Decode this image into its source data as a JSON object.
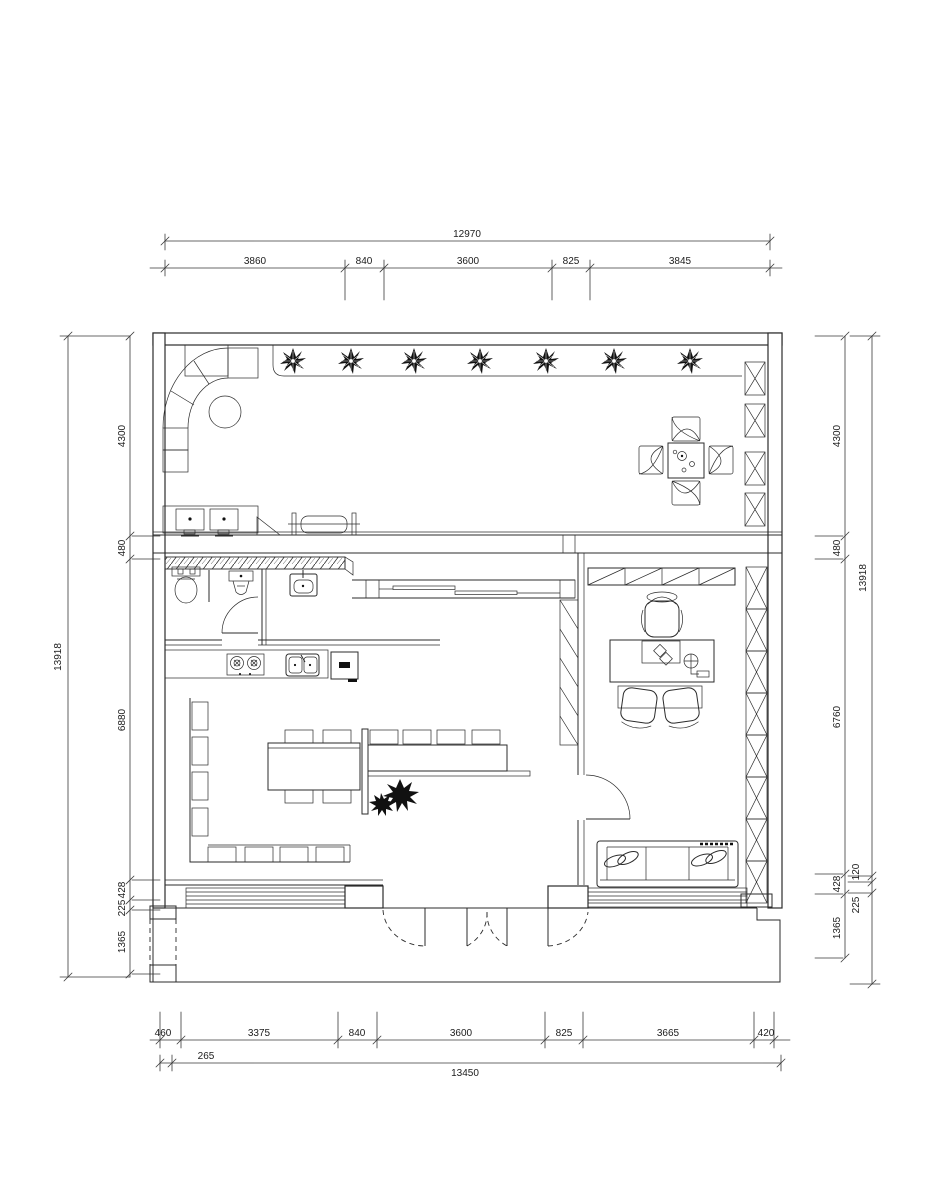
{
  "drawing": {
    "kind": "architectural floor plan",
    "units": "mm"
  },
  "dims": {
    "top": {
      "overall": "12970",
      "segs": [
        "3860",
        "840",
        "3600",
        "825",
        "3845"
      ]
    },
    "bottom": {
      "overall": "13450",
      "offset": "265",
      "segs": [
        "460",
        "3375",
        "840",
        "3600",
        "825",
        "3665",
        "420"
      ]
    },
    "left": {
      "overall": "13918",
      "segs": [
        "4300",
        "480",
        "6880",
        "428",
        "225",
        "1365"
      ]
    },
    "right": {
      "overall": "13918",
      "segs": [
        "4300",
        "480",
        "6760",
        "428",
        "1365"
      ],
      "outer_segs": [
        "120",
        "225"
      ]
    }
  },
  "elements": {
    "upper_room": [
      "corner-sofa",
      "round-table",
      "planter-plants",
      "bench",
      "side-chairs",
      "ramp-box",
      "dining-table",
      "dining-chairs",
      "lattice-screen"
    ],
    "wet_area": [
      "toilet",
      "urinal",
      "wash-basin",
      "swing-door"
    ],
    "kitchen": [
      "counter",
      "two-burner-stove",
      "double-sink",
      "fridge"
    ],
    "meeting": [
      "long-table",
      "chairs",
      "bench-seating",
      "divider-screen",
      "floor-plant",
      "sliding-window"
    ],
    "office": [
      "wardrobe",
      "desk",
      "executive-chair",
      "guest-chairs",
      "swing-door",
      "sofa",
      "steps",
      "lattice-screen"
    ],
    "entry": [
      "four-leaf-door",
      "steps",
      "platform",
      "dashed-column"
    ]
  }
}
